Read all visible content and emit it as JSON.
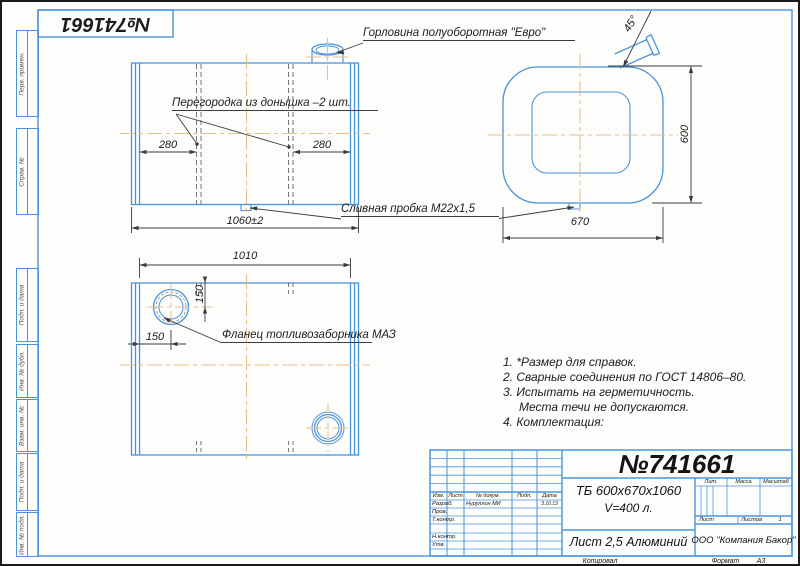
{
  "stamp_number": "№741661",
  "margin_boxes": [
    {
      "label": "Перв. примен."
    },
    {
      "label": "Справ. №"
    },
    {
      "label": "Подп. и дата"
    },
    {
      "label": "Инв. № дубл."
    },
    {
      "label": "Взам. инв. №"
    },
    {
      "label": "Подп. и дата"
    },
    {
      "label": "Инв. № подл."
    }
  ],
  "annotations": {
    "neck": "Горловина полуоборотная \"Евро\"",
    "partition": "Перегородка из донышка –2 шт.",
    "drain_plug": "Сливная пробка М22х1,5",
    "flange": "Фланец топливозаборника МАЗ"
  },
  "dimensions": {
    "front_left": "280",
    "front_right": "280",
    "front_length": "1060±2",
    "top_length": "1010",
    "flange_offset_v": "150",
    "flange_offset_h": "150",
    "side_height": "600",
    "side_width": "670",
    "neck_angle": "45°"
  },
  "notes": {
    "lines": [
      "1. *Размер для справок.",
      "2. Сварные соединения по ГОСТ 14806–80.",
      "3. Испытать на герметичность.",
      "Места течи не допускаются.",
      "4. Комплектация:"
    ]
  },
  "title_block": {
    "doc_number": "№741661",
    "designation_line1": "ТБ 600х670х1060",
    "designation_line2": "V=400 л.",
    "material": "Лист 2,5 Алюминий",
    "company": "ООО \"Компания Бакор\"",
    "col_izm": "Изм.",
    "col_list": "Лист",
    "col_doc": "№ докум.",
    "col_podp": "Подп.",
    "col_data": "Дата",
    "row_razrab": "Разраб.",
    "razrab_name": "Нуруллин МИ",
    "razrab_date": "3.10.13",
    "row_prov": "Пров.",
    "row_tkontr": "Т.контр.",
    "row_nkontr": "Н.контр.",
    "row_utv": "Утв.",
    "lit": "Лит.",
    "massa": "Масса",
    "masshtab": "Масштаб",
    "list_label": "Лист",
    "listov_label": "Листов",
    "listov_value": "1",
    "kopiroval": "Копировал",
    "format_label": "Формат",
    "format_value": "А3"
  },
  "colors": {
    "line_blue": "#4a94dd",
    "centerline_tan": "#e5c08d",
    "dim_dark": "#3a3a3a"
  }
}
